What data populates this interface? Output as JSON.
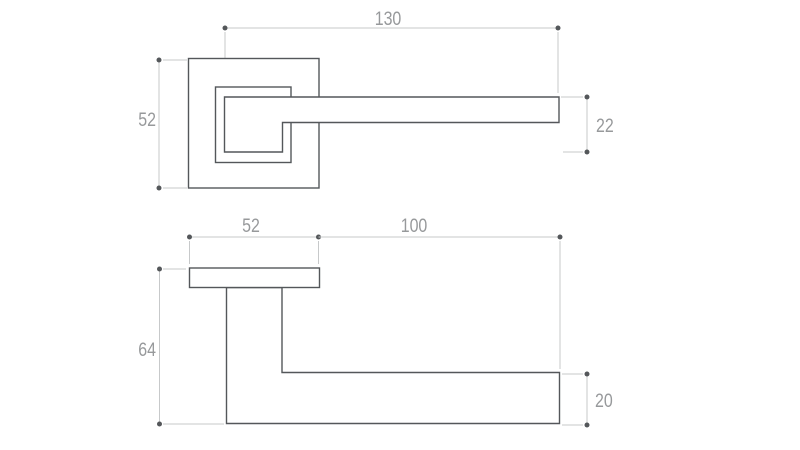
{
  "drawing": {
    "colors": {
      "background": "#ffffff",
      "outline": "#54575a",
      "dimension": "#c7c9ca",
      "dot": "#54575a",
      "label": "#97999b"
    },
    "front_view": {
      "dimensions": {
        "lever_length": "130",
        "rosette_size": "52",
        "lever_height": "22"
      }
    },
    "side_view": {
      "dimensions": {
        "rosette_width": "52",
        "lever_reach": "100",
        "overall_depth": "64",
        "lever_thickness": "20"
      }
    }
  }
}
